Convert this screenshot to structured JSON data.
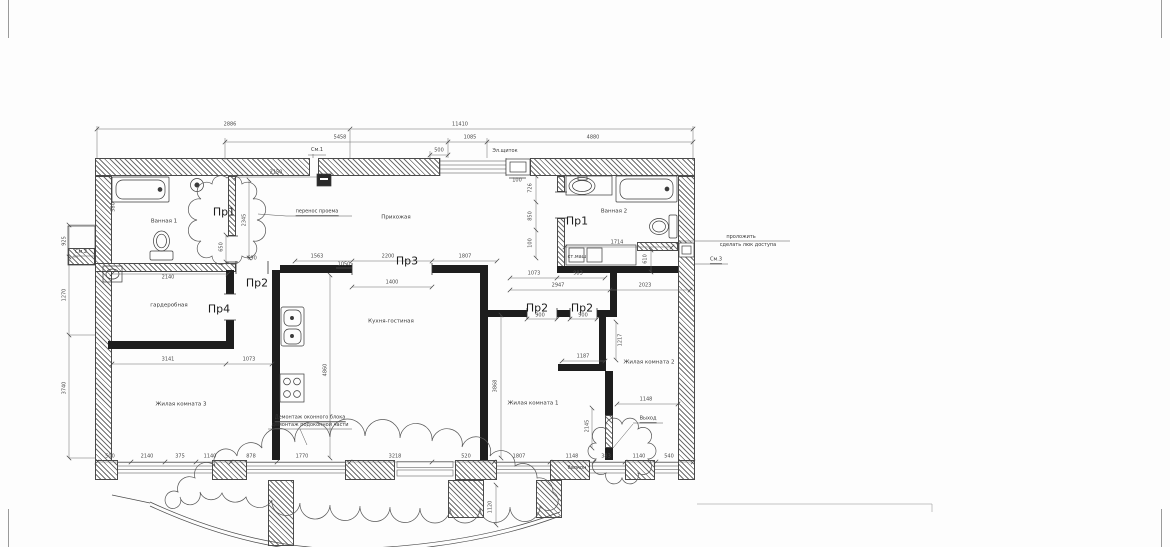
{
  "rooms": {
    "bath1": "Ванная 1",
    "hall": "Прихожая",
    "bath2": "Ванная 2",
    "wardrobe": "гардеробная",
    "kitchen": "Кухня-гостиная",
    "living3": "Жилая комната 3",
    "living1": "Жилая комната 1",
    "living2": "Жилая комната 2"
  },
  "marks": {
    "pr1_left": "Пр1",
    "pr2_left": "Пр2",
    "pr3": "Пр3",
    "pr4": "Пр4",
    "pr1_right": "Пр1",
    "pr2_mid": "Пр2",
    "pr2_right": "Пр2"
  },
  "notes": {
    "relocate_opening": "перенос проема",
    "electrical_panel": "Эл.щиток",
    "washing_machine": "ст.маш",
    "see1": "См.1",
    "see2": "См.2",
    "see3": "См.3",
    "lay_line1": "проложить",
    "lay_line2": "сделать люк доступа",
    "demolish_line1": "Демонтаж оконного блока",
    "demolish_line2": "демонтаж подоконной части",
    "exit": "Выход",
    "balcony": "балкон"
  },
  "dims": [
    "2886",
    "11410",
    "5458",
    "1085",
    "4880",
    "500",
    "2150",
    "2345",
    "650",
    "580",
    "925",
    "1270",
    "3740",
    "2140",
    "3141",
    "1073",
    "1563",
    "1050",
    "2200",
    "1807",
    "1400",
    "4860",
    "1073",
    "983",
    "2947",
    "2023",
    "726",
    "850",
    "100",
    "1714",
    "610",
    "900",
    "900",
    "1187",
    "1217",
    "3868",
    "1148",
    "2145",
    "500",
    "2140",
    "375",
    "1140",
    "878",
    "1770",
    "3218",
    "520",
    "1807",
    "1148",
    "383",
    "1140",
    "540",
    "1120",
    "690",
    "100"
  ],
  "colors": {
    "line": "#3a3a3a",
    "wall_new": "#1e1e1e",
    "background": "#fdfdfd"
  }
}
